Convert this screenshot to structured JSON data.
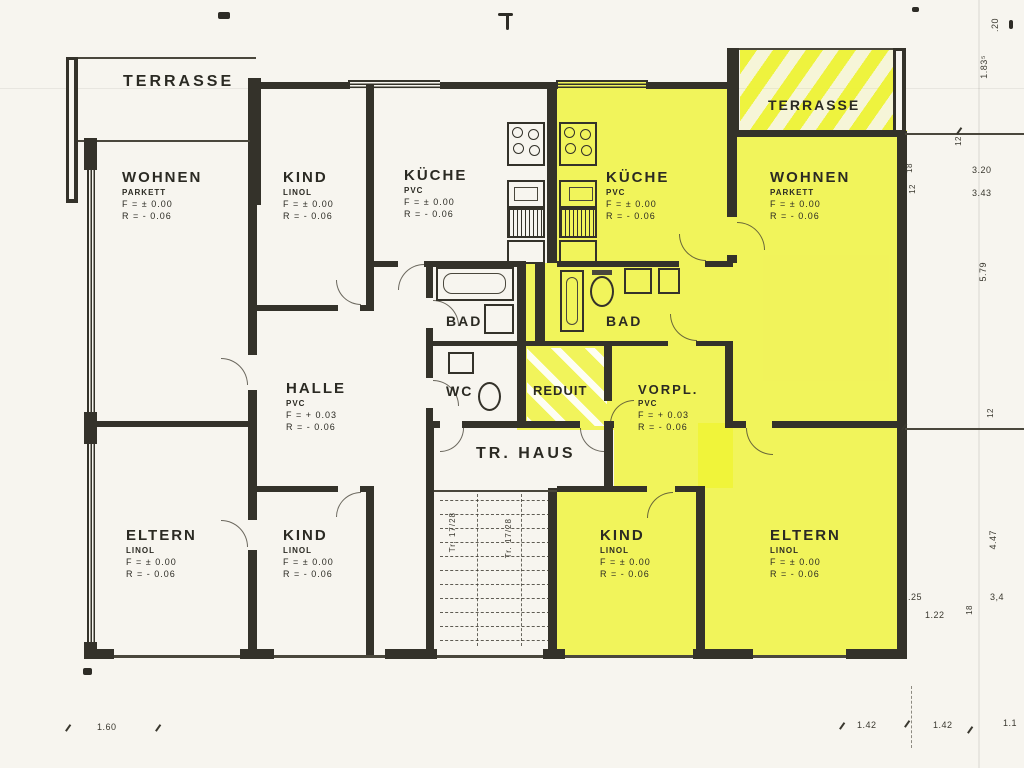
{
  "rooms": {
    "terrasse_left": {
      "name": "TERRASSE"
    },
    "wohnen_left": {
      "name": "WOHNEN",
      "floor": "PARKETT",
      "f": "F = ± 0.00",
      "r": "R = - 0.06"
    },
    "kind_top_left": {
      "name": "KIND",
      "floor": "LINOL",
      "f": "F = ± 0.00",
      "r": "R = - 0.06"
    },
    "kueche_left": {
      "name": "KÜCHE",
      "floor": "PVC",
      "f": "F = ± 0.00",
      "r": "R = - 0.06"
    },
    "kueche_right": {
      "name": "KÜCHE",
      "floor": "PVC",
      "f": "F = ± 0.00",
      "r": "R = - 0.06"
    },
    "wohnen_right": {
      "name": "WOHNEN",
      "floor": "PARKETT",
      "f": "F = ± 0.00",
      "r": "R = - 0.06"
    },
    "terrasse_right": {
      "name": "TERRASSE"
    },
    "bad_left": {
      "name": "BAD"
    },
    "bad_right": {
      "name": "BAD"
    },
    "wc": {
      "name": "WC"
    },
    "reduit": {
      "name": "REDUIT"
    },
    "vorplatz": {
      "name": "VORPL.",
      "floor": "PVC",
      "f": "F = + 0.03",
      "r": "R = - 0.06"
    },
    "halle": {
      "name": "HALLE",
      "floor": "PVC",
      "f": "F = + 0.03",
      "r": "R = - 0.06"
    },
    "treppenhaus": {
      "name": "TR. HAUS",
      "stair_note": "Tr. 17/28"
    },
    "eltern_left": {
      "name": "ELTERN",
      "floor": "LINOL",
      "f": "F = ± 0.00",
      "r": "R = - 0.06"
    },
    "kind_bottom_left": {
      "name": "KIND",
      "floor": "LINOL",
      "f": "F = ± 0.00",
      "r": "R = - 0.06"
    },
    "kind_bottom_right": {
      "name": "KIND",
      "floor": "LINOL",
      "f": "F = ± 0.00",
      "r": "R = - 0.06"
    },
    "eltern_right": {
      "name": "ELTERN",
      "floor": "LINOL",
      "f": "F = ± 0.00",
      "r": "R = - 0.06"
    }
  },
  "dimensions": {
    "right_020": ".20",
    "right_183": "1.83⁵",
    "right_12_top": "12",
    "right_320": "3.20",
    "right_343": "3.43",
    "right_579": "5.79",
    "wall_18": "18",
    "wall_12": "12",
    "right_12_mid": "12",
    "right_447": "4.47",
    "right_025": ".25",
    "right_34": "3,4",
    "right_122": "1.22",
    "right_18_low": "18",
    "bottom_160": "1.60",
    "bottom_142_a": "1.42",
    "bottom_142_b": "1.42",
    "bottom_11": "1.1"
  },
  "colors": {
    "highlight": "#eff331",
    "ink": "#34322a",
    "paper": "#f7f5ef"
  }
}
